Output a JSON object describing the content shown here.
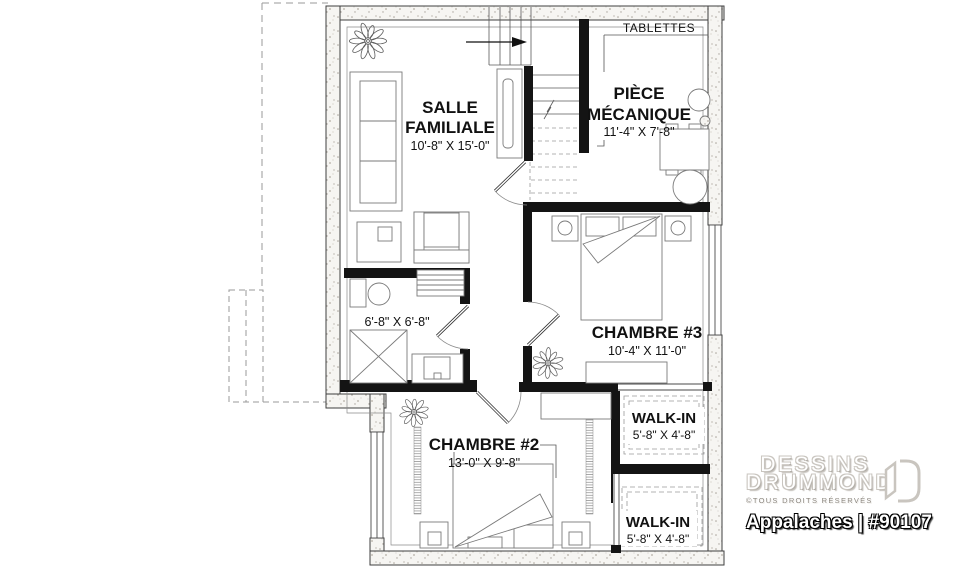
{
  "plan": {
    "tablettes_label": "TABLETTES",
    "rooms": {
      "salle_familiale": {
        "line1": "SALLE",
        "line2": "FAMILIALE",
        "dims": "10'-8\" X 15'-0\""
      },
      "piece_mecanique": {
        "line1": "PIÈCE",
        "line2": "MÉCANIQUE",
        "dims": "11'-4\" X 7'-8\""
      },
      "chambre_3": {
        "name": "CHAMBRE #3",
        "dims": "10'-4\" X 11'-0\""
      },
      "chambre_2": {
        "name": "CHAMBRE #2",
        "dims": "13'-0\" X 9'-8\""
      },
      "walk_in_1": {
        "name": "WALK-IN",
        "dims": "5'-8\" X 4'-8\""
      },
      "walk_in_2": {
        "name": "WALK-IN",
        "dims": "5'-8\" X 4'-8\""
      },
      "salle_de_bain": {
        "dims": "6'-8\" X 6'-8\""
      }
    }
  },
  "branding": {
    "company_line1": "DESSINS",
    "company_line2": "DRUMMOND",
    "rights": "©TOUS DROITS RÉSERVÉS",
    "plan_title": "Appalaches | #90107"
  },
  "colors": {
    "wall_fill": "#f6f5f2",
    "wall_stipple": "#a9a39b",
    "interior_wall": "#141414",
    "thin_line": "#555555",
    "logo_gray": "#c9c5bf"
  }
}
